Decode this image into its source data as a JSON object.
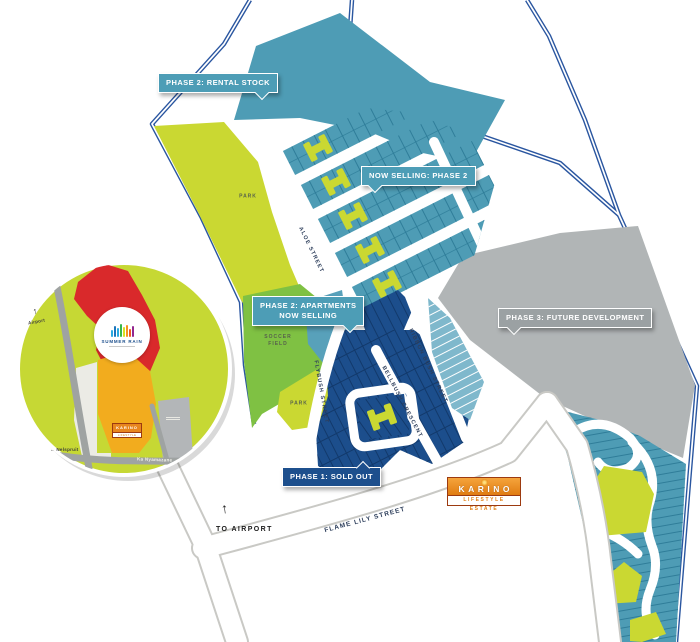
{
  "bubbles": {
    "phase2_rental": {
      "label": "PHASE 2: RENTAL STOCK"
    },
    "now_selling": {
      "label": "NOW SELLING: PHASE 2"
    },
    "phase2_apartments": {
      "line1": "PHASE 2: APARTMENTS",
      "line2": "NOW SELLING"
    },
    "phase3_future": {
      "label": "PHASE 3: FUTURE DEVELOPMENT"
    },
    "phase1_sold": {
      "label": "PHASE 1: SOLD OUT"
    }
  },
  "streets": {
    "aloe": "ALOE STREET",
    "flybush": "FLYBUSH STREET",
    "bellbush": "BELLBUSH CRESCENT",
    "ribbon_bush": "RIBBON BUSH STREET",
    "flame_lily": "FLAME LILY STREET"
  },
  "areas": {
    "park_upper": "PARK",
    "park_lower": "PARK",
    "soccer_line1": "SOCCER",
    "soccer_line2": "FIELD",
    "to_airport": "TO AIRPORT"
  },
  "logo": {
    "name": "KARINO",
    "tagline": "LIFESTYLE ESTATE"
  },
  "inset": {
    "airport": "Airport",
    "nelspruit": "Nelspruit",
    "ka_nyamazane": "Ka Nyamazane",
    "summer_rain": "SUMMER RAIN",
    "karino": "KARINO",
    "karino_tagline": "LIFESTYLE ESTATE"
  },
  "icons": {
    "up_arrow": "↑",
    "left_arrow": "←"
  },
  "colors": {
    "teal_plots": "#4E9CB5",
    "teal_bubble": "#4D9DB6",
    "navy_phase1": "#1C4E8C",
    "navy_bubble": "#1D4F8D",
    "gray_phase3": "#B1B5B6",
    "gray_bubble": "#9BA1A3",
    "park_green": "#CAD832",
    "field_green": "#7FC143",
    "light_blue_plots": "#7FB8CC",
    "boundary_blue": "#2A56A0",
    "karino_orange": "#E8861E",
    "inset_red": "#D9292B",
    "inset_amber": "#F2AC1E",
    "inset_green": "#C6D834"
  }
}
